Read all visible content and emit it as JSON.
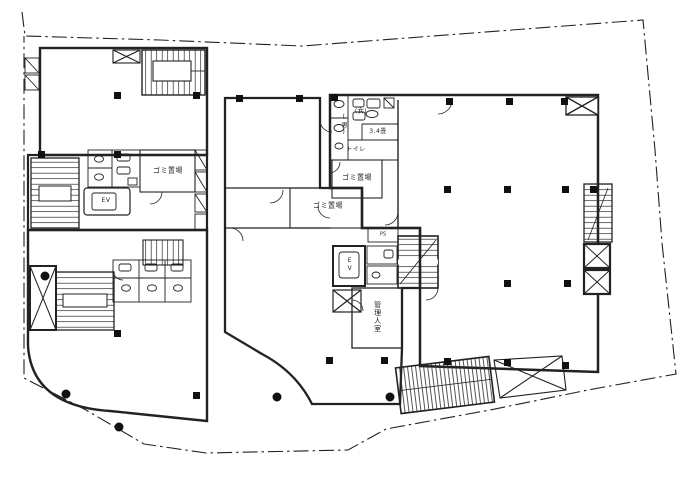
{
  "plan": {
    "type": "architectural-floor-plan",
    "labels": {
      "garbage_room_left": "ゴミ置場",
      "garbage_room_right": "ゴミ置場",
      "garbage_room_middle": "ゴミ置場",
      "toilet": "トイレ",
      "mens": "(男)",
      "womens": "(女)",
      "room_size": "3.4畳",
      "managers_room": "管理人室",
      "elevator_left": "EV",
      "elevator_center": "EV",
      "pipe_space": "PS"
    },
    "colors": {
      "ink": "#1c1c1c",
      "paper": "#ffffff"
    }
  }
}
